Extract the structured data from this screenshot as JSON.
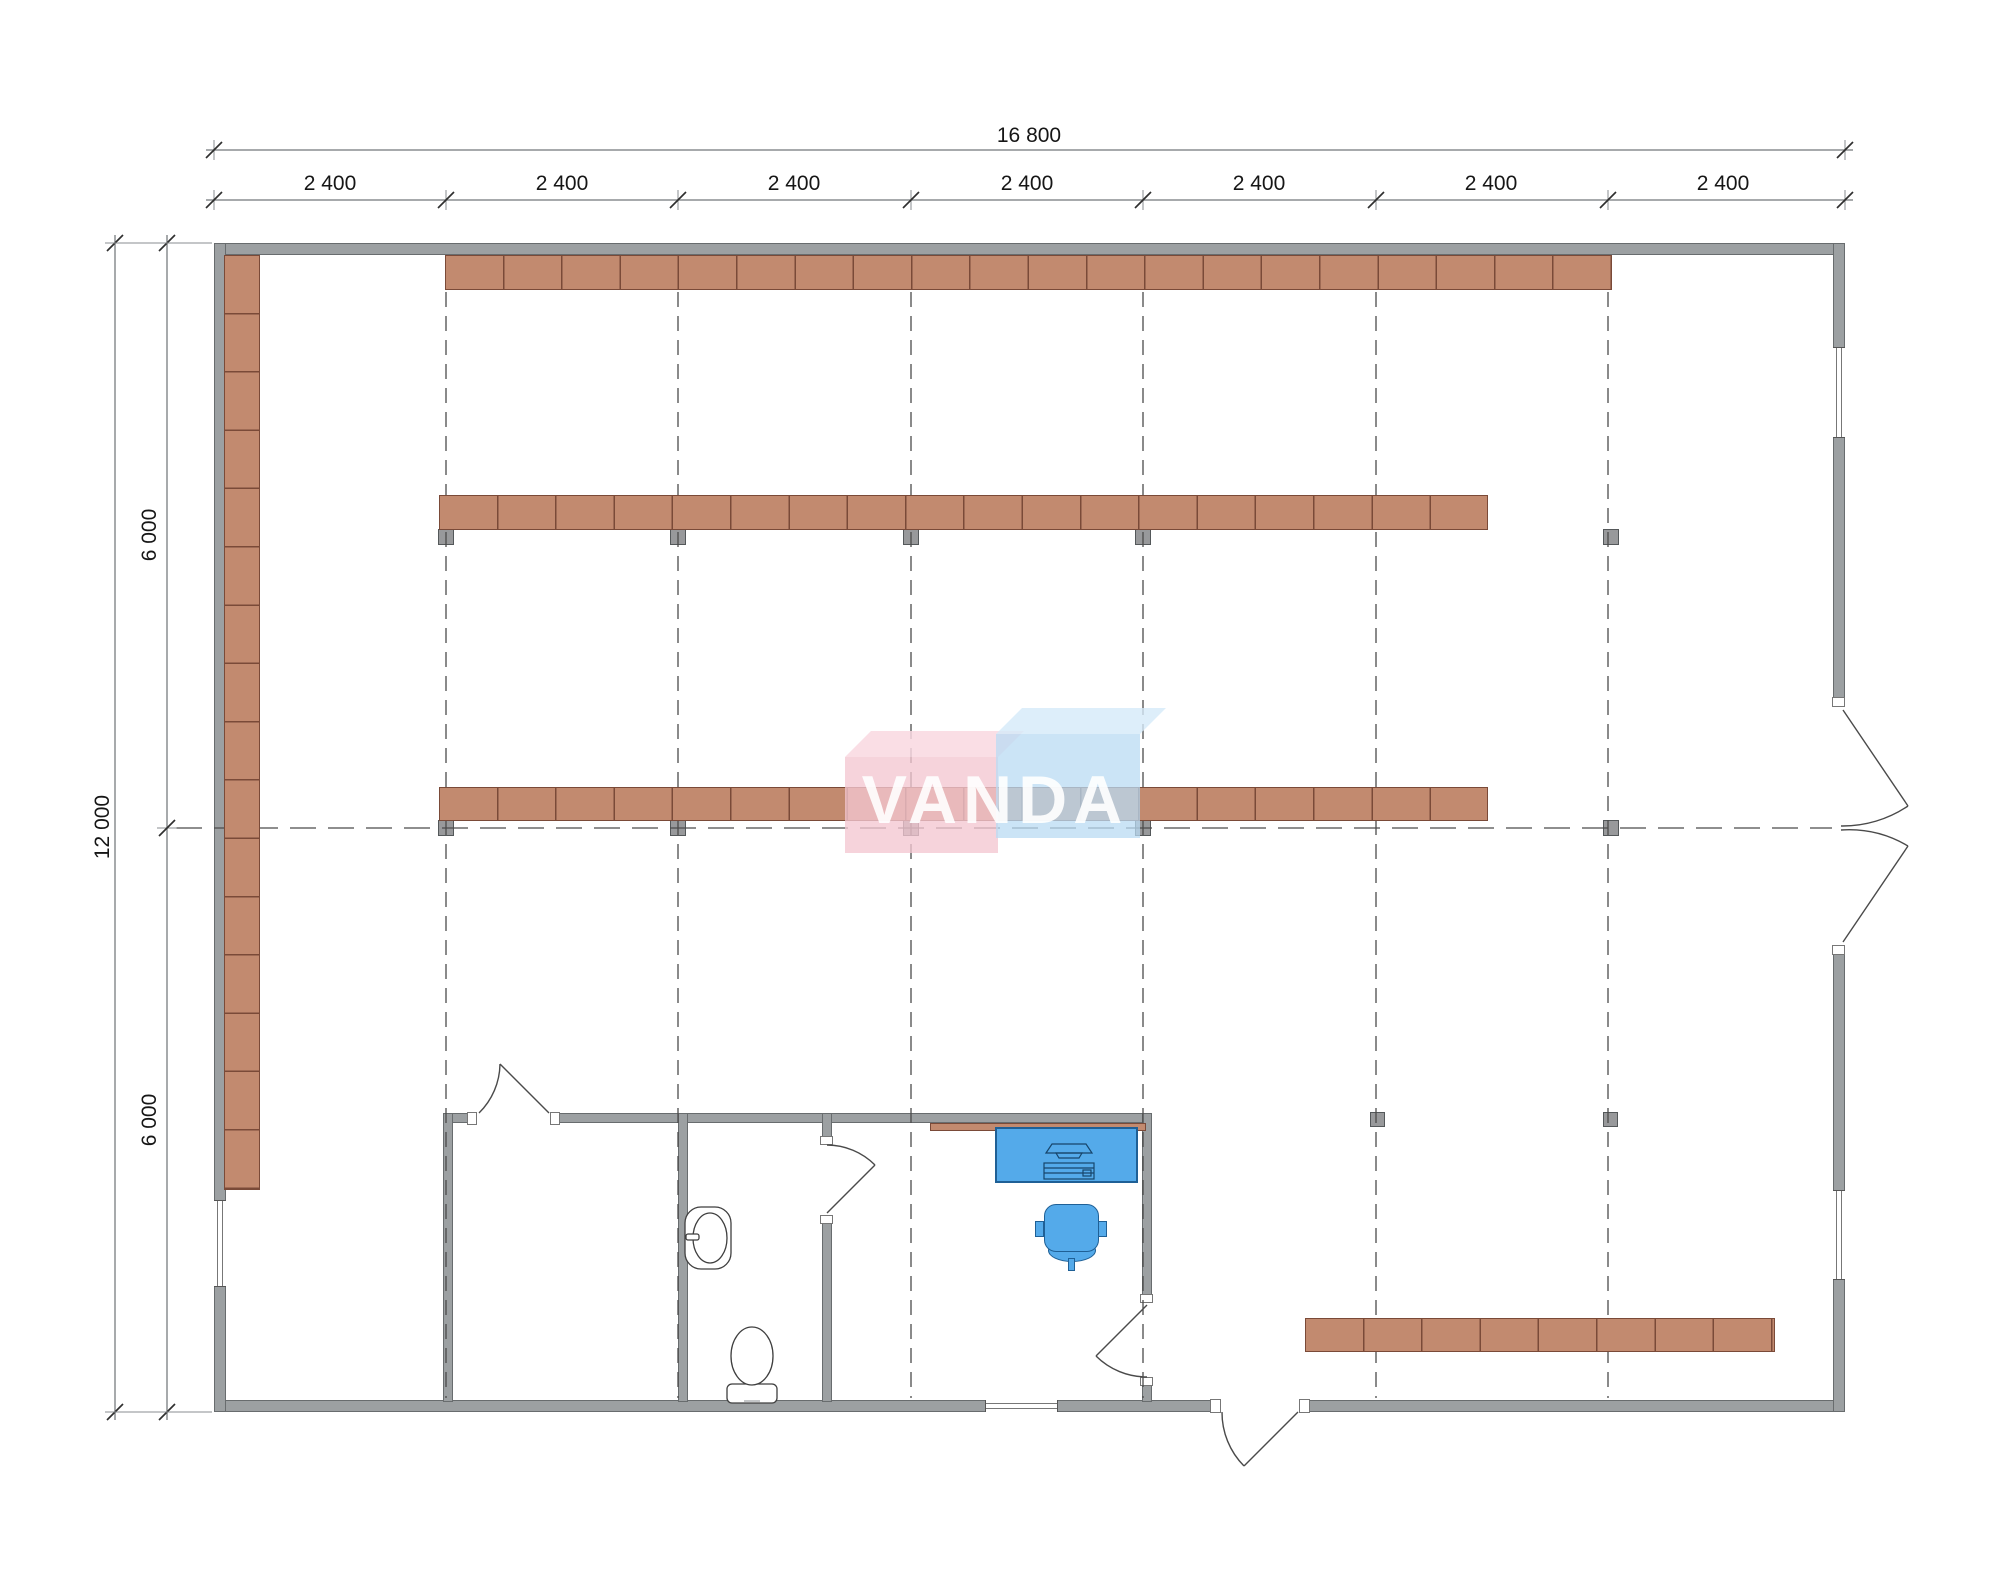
{
  "watermark": {
    "text": "VANDA"
  },
  "dimensions": {
    "top": {
      "overall": "16 800",
      "segments": [
        "2 400",
        "2 400",
        "2 400",
        "2 400",
        "2 400",
        "2 400",
        "2 400"
      ]
    },
    "left": {
      "overall": "12 000",
      "segments": [
        "6 000",
        "6 000"
      ]
    }
  },
  "colors": {
    "wall": "#9ca0a2",
    "wall_line": "#686c6e",
    "shelf": "#c28a6f",
    "shelf_border": "#7a4a38",
    "post": "#98999b",
    "post_border": "#54585a",
    "furniture_blue": "#54aaea",
    "furniture_border": "#1f6096",
    "dash": "#4b4b4b",
    "dim_line": "#8a8e90",
    "dim_text": "#161616",
    "logo_pink": "rgba(244,199,209,0.78)",
    "logo_pink_top": "rgba(249,216,224,0.85)",
    "logo_blue": "rgba(186,219,243,0.75)",
    "logo_blue_top": "rgba(213,234,249,0.8)"
  }
}
